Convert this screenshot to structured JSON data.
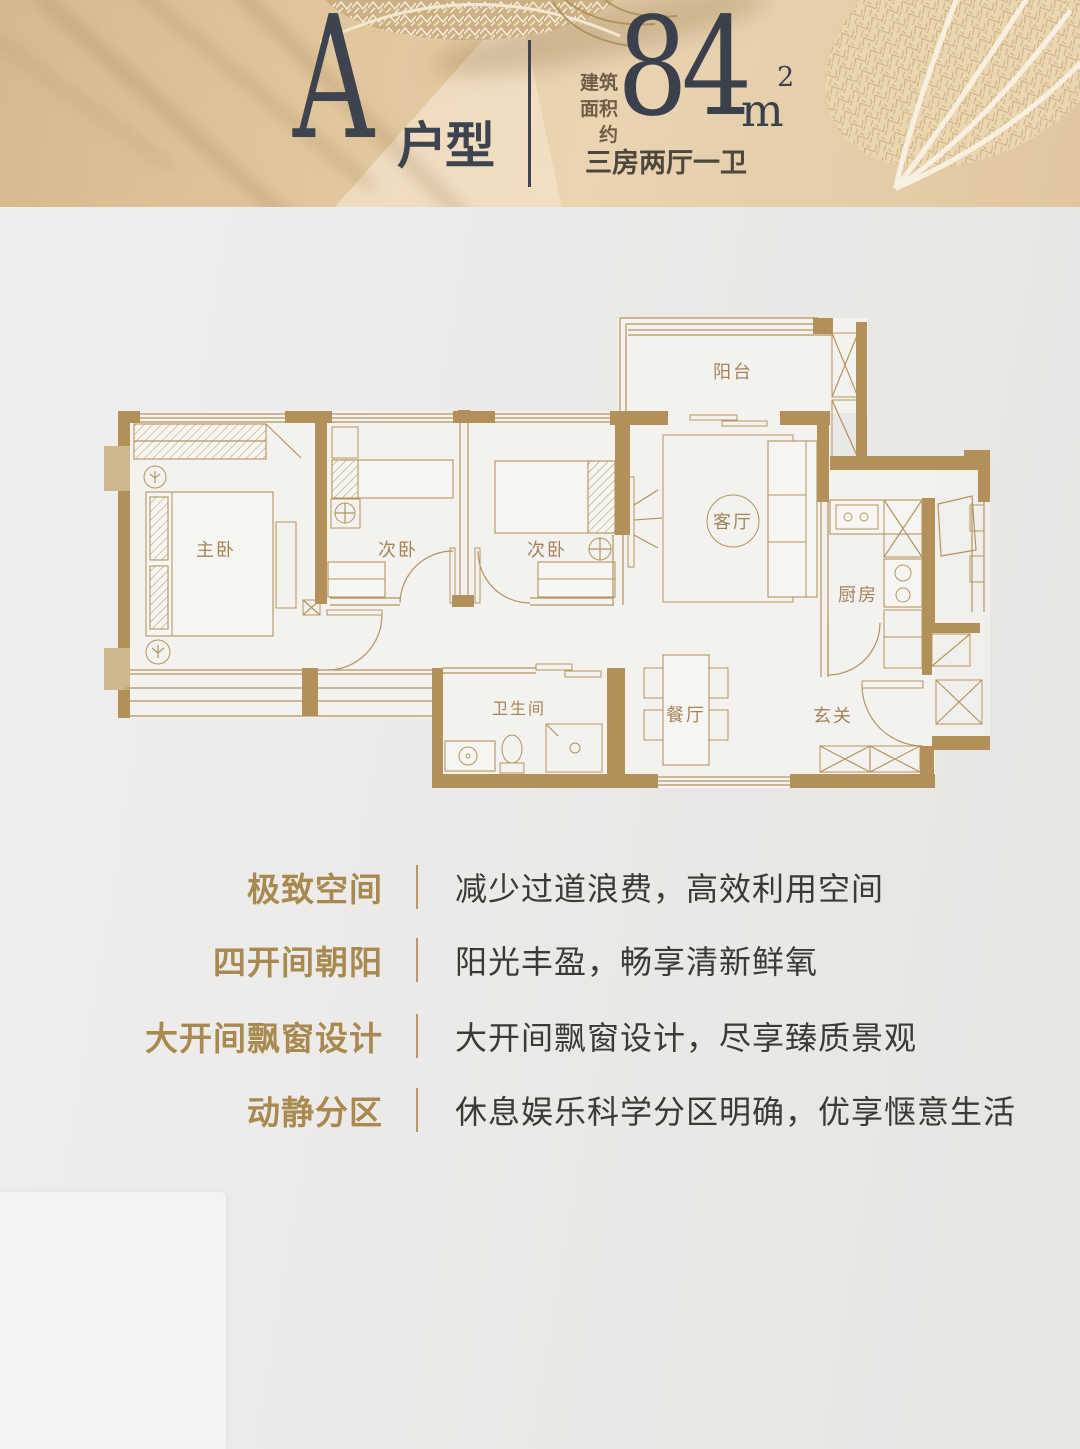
{
  "header": {
    "unit_letter": "A",
    "unit_type_suffix": "户型",
    "area_label_lines": [
      "建筑",
      "面积",
      "约"
    ],
    "area_value": "84",
    "area_unit": "m",
    "area_exponent": "2",
    "layout_summary": "三房两厅一卫"
  },
  "floorplan": {
    "rooms": [
      {
        "id": "balcony",
        "label": "阳台"
      },
      {
        "id": "master-bedroom",
        "label": "主卧"
      },
      {
        "id": "bedroom-2",
        "label": "次卧"
      },
      {
        "id": "bedroom-3",
        "label": "次卧"
      },
      {
        "id": "living-room",
        "label": "客厅"
      },
      {
        "id": "kitchen",
        "label": "厨房"
      },
      {
        "id": "bathroom",
        "label": "卫生间"
      },
      {
        "id": "dining-room",
        "label": "餐厅"
      },
      {
        "id": "foyer",
        "label": "玄关"
      }
    ]
  },
  "features": [
    {
      "title": "极致空间",
      "description": "减少过道浪费，高效利用空间"
    },
    {
      "title": "四开间朝阳",
      "description": "阳光丰盈，畅享清新鲜氧"
    },
    {
      "title": "大开间飘窗设计",
      "description": "大开间飘窗设计，尽享臻质景观"
    },
    {
      "title": "动静分区",
      "description": "休息娱乐科学分区明确，优享惬意生活"
    }
  ],
  "colors": {
    "header_tan": "#e2c8a0",
    "accent_gold": "#a8894f",
    "wall_tan": "#b3905a",
    "text_dark": "#3e4350",
    "body_bg": "#ebeae8"
  }
}
